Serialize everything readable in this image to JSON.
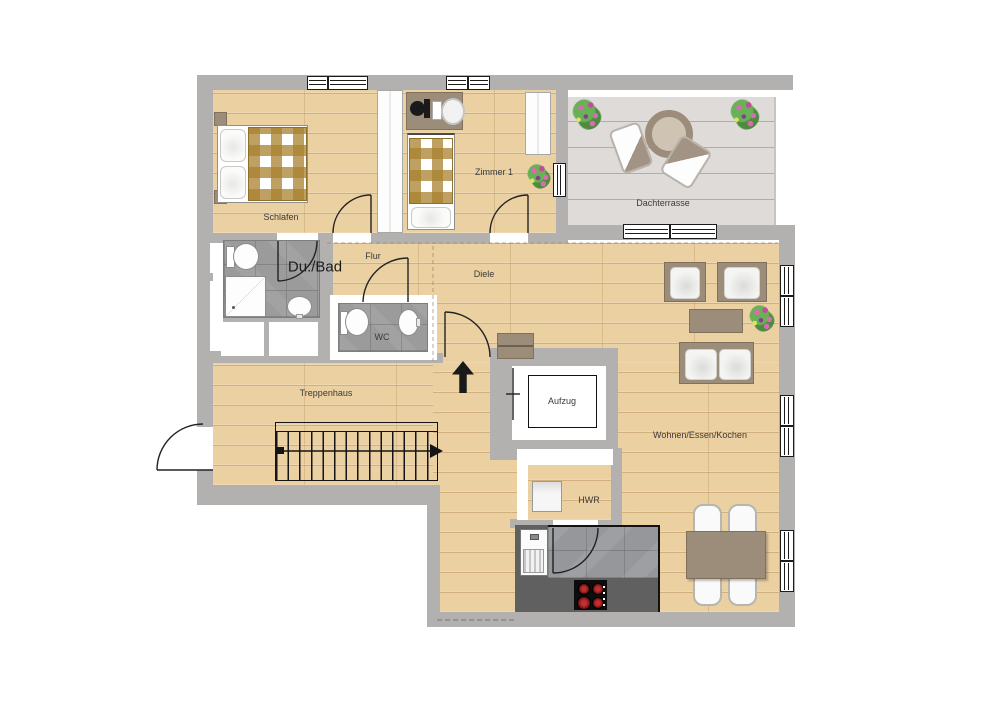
{
  "plan": {
    "type": "apartment-floor-plan",
    "labels": {
      "schlafen": "Schlafen",
      "zimmer1": "Zimmer 1",
      "dachterrasse": "Dachterrasse",
      "du_bad": "Du./Bad",
      "flur": "Flur",
      "diele": "Diele",
      "wc": "WC",
      "treppenhaus": "Treppenhaus",
      "aufzug": "Aufzug",
      "hwr": "HWR",
      "wohnen_essen_kochen": "Wohnen/Essen/Kochen"
    },
    "colors": {
      "wall": "#b3b1b0",
      "wood_floor": "#ebd0a1",
      "terrace_deck": "#dfdbd9",
      "bath_tile": "#9b9b9b",
      "kitchen_tile": "#95979a",
      "kitchen_counter": "#606060",
      "furniture": "#9c8c7a",
      "blanket_check": "#a9812e",
      "stove": "#111111",
      "burner_red": "#8c1616"
    },
    "icons": {
      "north_arrow": "up-arrow",
      "stairs_direction": "right-arrow",
      "plants": "flower-plant"
    }
  }
}
